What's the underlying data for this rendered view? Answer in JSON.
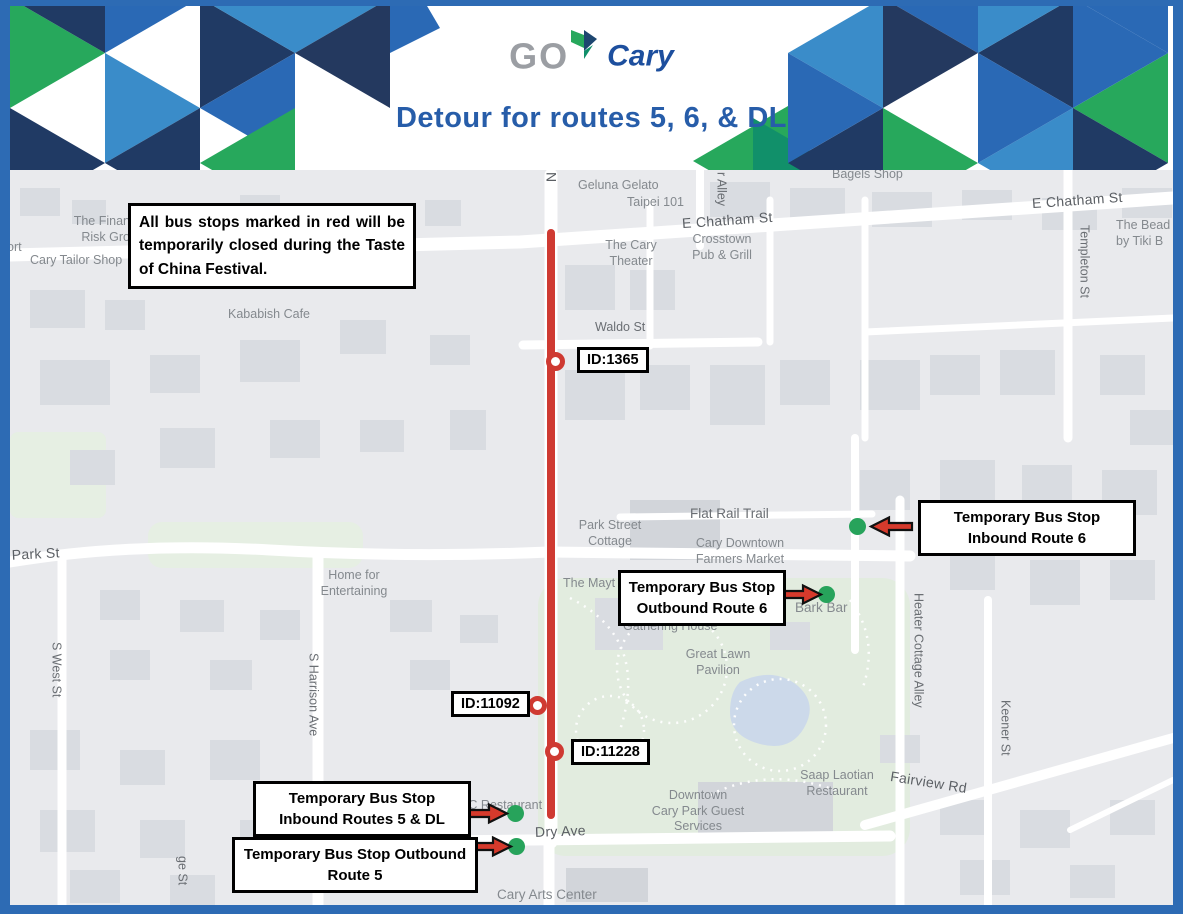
{
  "header": {
    "logo": {
      "go": "GO",
      "cary": "Cary"
    },
    "title": "Detour for routes 5, 6, & DL"
  },
  "notice": "All bus stops marked in red will be temporarily closed during the Taste of China Festival.",
  "closed_stops": [
    {
      "id": "ID:1365"
    },
    {
      "id": "ID:11092"
    },
    {
      "id": "ID:11228"
    }
  ],
  "temp_stops": [
    {
      "label": "Temporary Bus Stop Inbound Route 6"
    },
    {
      "label": "Temporary Bus Stop Outbound Route 6"
    },
    {
      "label": "Temporary Bus Stop Inbound Routes 5 & DL"
    },
    {
      "label": "Temporary Bus Stop Outbound Route 5"
    }
  ],
  "map_labels": {
    "n_street": "N",
    "r_alley": "r Alley",
    "geluna": "Geluna Gelato",
    "taipei": "Taipei 101",
    "chatham_w": "E Chatham St",
    "chatham_e": "E Chatham St",
    "bagels": "Bagels Shop",
    "cary_theater": "The Cary\nTheater",
    "crosstown": "Crosstown\nPub & Grill",
    "tiki": "The Bead\nby Tiki B",
    "templeton": "Templeton St",
    "financial": "The Finan\nRisk Gro",
    "ort": "ort",
    "tailor": "Cary Tailor Shop",
    "kababish": "Kababish Cafe",
    "waldo": "Waldo St",
    "flat_rail": "Flat Rail Trail",
    "park_cottage": "Park Street\nCottage",
    "farmers": "Cary Downtown\nFarmers Market",
    "park_st": "W Park St",
    "home_ent": "Home for\nEntertaining",
    "the_may": "The Mayt",
    "gathering": "Gathering House",
    "great_lawn": "Great Lawn\nPavilion",
    "bark_bar": "Bark Bar",
    "s_west": "S West St",
    "harrison": "S Harrison Ave",
    "heater": "Heater Cottage Alley",
    "keener": "Keener St",
    "saap": "Saap Laotian\nRestaurant",
    "fairview": "Fairview Rd",
    "downtown_park": "Downtown\nCary Park Guest\nServices",
    "dry_ave": "Dry Ave",
    "mc_rest": "MC Restaurant",
    "arts_center": "Cary Arts Center",
    "ge_st": "ge St"
  },
  "colors": {
    "frame_blue": "#2d6bb4",
    "title_blue": "#275da9",
    "route_red": "#cf3a32",
    "temp_stop_green": "#27a35b"
  }
}
